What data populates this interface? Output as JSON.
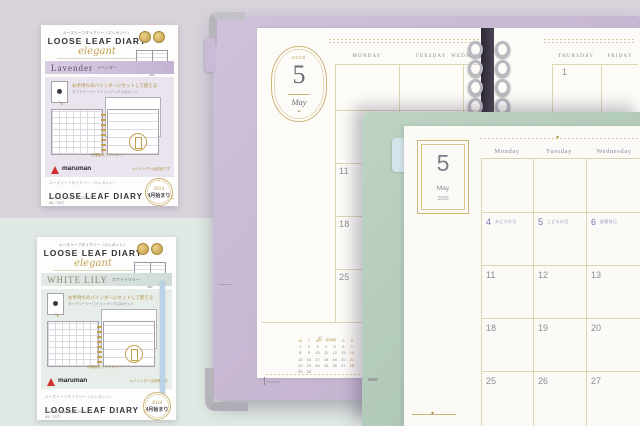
{
  "icons": {
    "diamond": "◆",
    "sparkle": "✦",
    "arrow": "↪"
  },
  "package_lavender": {
    "brand_line": "ルーズリーフダイアリー〈エレガント〉",
    "title": "LOOSE LEAF DIARY",
    "script_name": "elegant",
    "color_name": "Lavender",
    "color_kana": "ラベンダー",
    "spec_size": "A5",
    "spec_format": "MONTHLY",
    "spec_range": "2024.4 ▶ 2025.3",
    "feature_heading": "お手持ちのバインダーにセットして使える",
    "feature_sub": "ダイアリーリーフ＋インデックスのセット",
    "callout": "月曜始まりマンスリー",
    "logo_text": "maruman",
    "logo_note": "＊バインダーは別売です",
    "footer_line": "ルーズリーフダイアリー〈エレガント〉",
    "footer_title": "LOOSE LEAF DIARY",
    "footer_script": "elegant",
    "footer_spec1": "monthly／2024.4 ▶ 2025.3",
    "footer_spec2": "A5／20穴",
    "badge_year": "2024",
    "badge_label": "4月始まり"
  },
  "package_whitelily": {
    "brand_line": "ルーズリーフダイアリー〈エレガント〉",
    "title": "LOOSE LEAF DIARY",
    "script_name": "elegant",
    "color_name": "WHITE LILY",
    "color_kana": "ホワイトリリー",
    "spec_size": "A5",
    "spec_format": "MONTHLY",
    "spec_range": "2024.4 ▶ 2025.3",
    "feature_heading": "お手持ちのバインダーにセットして使える",
    "feature_sub": "ダイアリーリーフ＋インデックスのセット",
    "callout": "月曜始まりマンスリー",
    "logo_text": "maruman",
    "logo_note": "＊バインダーは別売です",
    "footer_line": "ルーズリーフダイアリー〈エレガント〉",
    "footer_title": "LOOSE LEAF DIARY",
    "footer_script": "elegant",
    "footer_spec1": "monthly／2024.4 ▶ 2025.3",
    "footer_spec2": "A5／20穴",
    "badge_year": "2024",
    "badge_label": "4月始まり"
  },
  "binder_back": {
    "frame_year": "2020",
    "frame_date": "5",
    "frame_month": "May",
    "weekday_monday": "MONDAY",
    "weekday_tuesday": "TUESDAY",
    "weekday_wednesday": "WEDNESDAY",
    "weekday_thursday": "THURSDAY",
    "weekday_friday": "FRIDAY",
    "monday_dates": [
      "11",
      "18",
      "25"
    ],
    "thursday_date": "1",
    "memo_label": "memo",
    "mini_cal": {
      "title_num": "6",
      "title_name": "June",
      "day_headers": [
        "M",
        "T",
        "W",
        "T",
        "F",
        "S",
        "S"
      ],
      "weeks": [
        [
          "1",
          "2",
          "3",
          "4",
          "5",
          "6",
          "7"
        ],
        [
          "8",
          "9",
          "10",
          "11",
          "12",
          "13",
          "14"
        ],
        [
          "15",
          "16",
          "17",
          "18",
          "19",
          "20",
          "21"
        ],
        [
          "22",
          "23",
          "24",
          "25",
          "26",
          "27",
          "28"
        ],
        [
          "29",
          "30",
          "",
          "",
          "",
          "",
          ""
        ]
      ]
    }
  },
  "binder_front": {
    "frame_date": "5",
    "frame_month": "May",
    "frame_year": "2020",
    "weekday_monday": "Monday",
    "weekday_tuesday": "Tuesday",
    "weekday_wednesday": "Wednesday",
    "week2": [
      {
        "date": "4",
        "note": "みどりの日"
      },
      {
        "date": "5",
        "note": "こどもの日"
      },
      {
        "date": "6",
        "note": "振替休日"
      }
    ],
    "week3": [
      "11",
      "12",
      "13"
    ],
    "week4": [
      "18",
      "19",
      "20"
    ],
    "week5": [
      "25",
      "26",
      "27"
    ]
  },
  "colors": {
    "lavender_cover": "#c7b6d2",
    "sage_cover": "#b5cbba",
    "gold_accent": "#c9a855",
    "holiday_purple": "#7a74ae",
    "sunday_orange": "#cd8050",
    "backdrop_lavender": "#d8d2db",
    "backdrop_mint": "#e0e9e4"
  }
}
